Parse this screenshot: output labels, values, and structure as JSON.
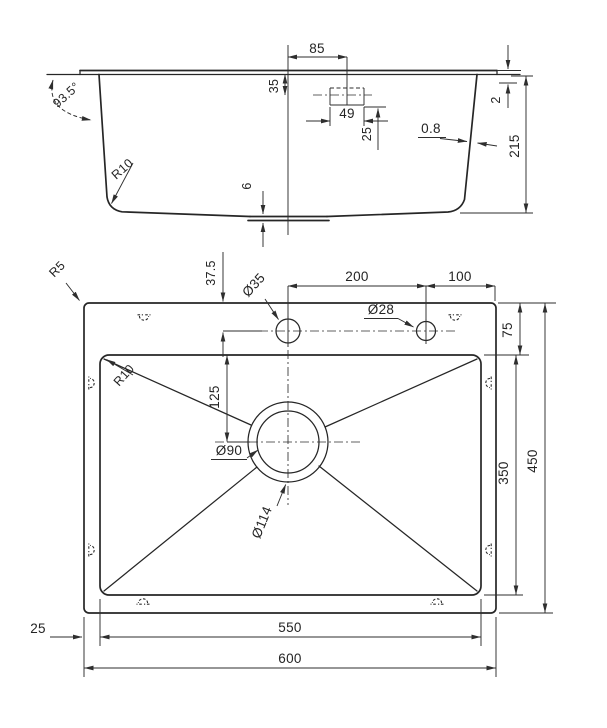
{
  "drawing": {
    "title": "sink-technical-drawing",
    "background_color": "#ffffff",
    "line_color": "#262626",
    "side_view": {
      "dim_85": "85",
      "dim_35": "35",
      "dim_49": "49",
      "dim_25": "25",
      "dim_0_8": "0.8",
      "dim_2": "2",
      "dim_215": "215",
      "dim_6": "6",
      "angle_93_5": "93.5°",
      "radius_r10": "R10"
    },
    "plan_view": {
      "radius_r5": "R5",
      "dim_37_5": "37.5",
      "dia_35": "Ø35",
      "dim_200": "200",
      "dim_100": "100",
      "dia_28": "Ø28",
      "dim_75": "75",
      "radius_r10": "R10",
      "dim_125": "125",
      "dia_90": "Ø90",
      "dia_114": "Ø114",
      "dim_350": "350",
      "dim_450": "450",
      "dim_550": "550",
      "dim_600": "600",
      "dim_25": "25"
    }
  }
}
